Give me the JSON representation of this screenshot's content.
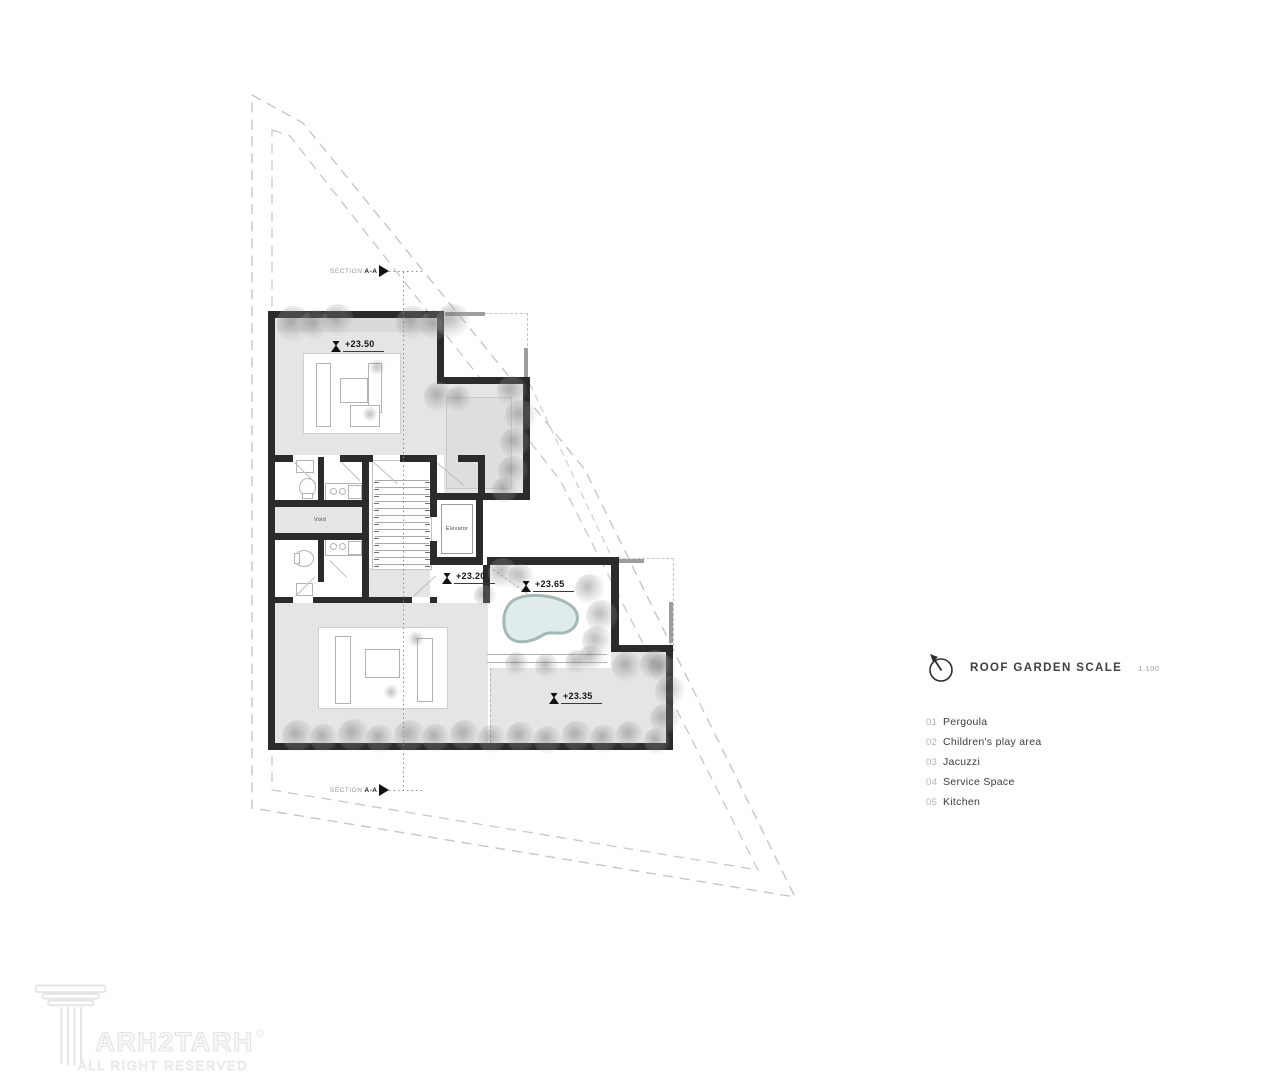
{
  "plan": {
    "section_label": {
      "prefix": "SECTION",
      "suffix": "A-A"
    },
    "rooms": {
      "void": "Void",
      "elevator": "Elevator"
    },
    "levels": {
      "upper_roof": "+23.50",
      "stair_lobby": "+23.20",
      "jacuzzi_deck": "+23.65",
      "play_area": "+23.35"
    }
  },
  "legend": {
    "title": "ROOF GARDEN SCALE",
    "scale": "1.100",
    "items": [
      {
        "num": "01",
        "label": "Pergoula"
      },
      {
        "num": "02",
        "label": "Children's play area"
      },
      {
        "num": "03",
        "label": "Jacuzzi"
      },
      {
        "num": "04",
        "label": "Service Space"
      },
      {
        "num": "05",
        "label": "Kitchen"
      }
    ]
  },
  "watermark": {
    "brand": "ARH2TARH",
    "sub": "ALL RIGHT RESERVED",
    "copyright": "©"
  },
  "colors": {
    "wall": "#2b2b2b",
    "floor": "#e5e5e5",
    "pool_fill": "#e0ecec",
    "pool_edge": "#a3b8b8",
    "boundary_dash": "#c6c6c6",
    "text_dark": "#3c3c3c",
    "text_light": "#b3b3b3"
  }
}
